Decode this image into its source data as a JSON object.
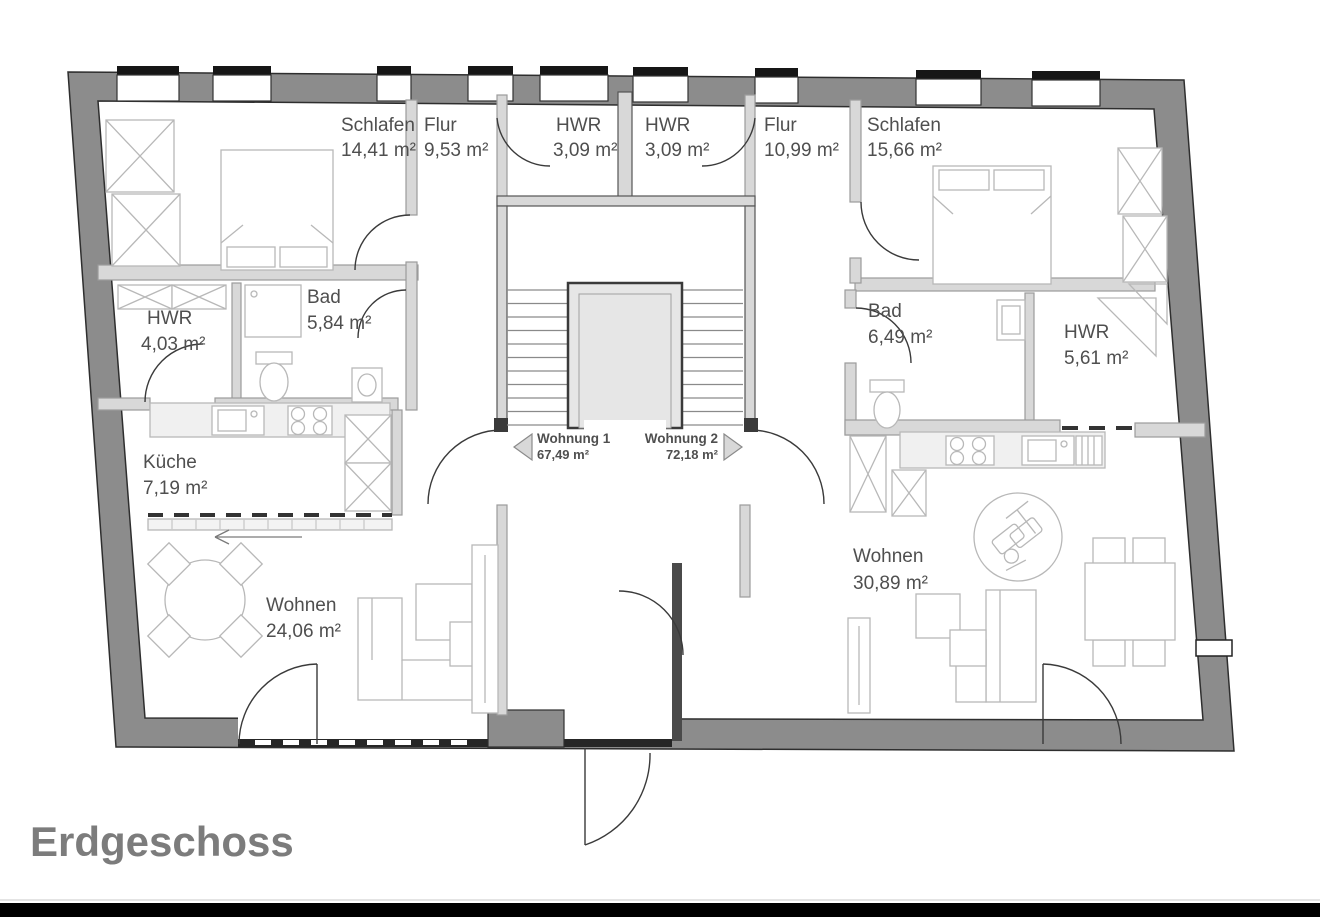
{
  "title": "Erdgeschoss",
  "floor_plan": {
    "apartments": [
      {
        "label": "Wohnung 1",
        "area": "67,49 m²"
      },
      {
        "label": "Wohnung 2",
        "area": "72,18 m²"
      }
    ],
    "rooms": [
      {
        "name": "Schlafen",
        "area": "14,41 m²"
      },
      {
        "name": "Flur",
        "area": "9,53 m²"
      },
      {
        "name": "HWR",
        "area": "3,09 m²"
      },
      {
        "name": "HWR",
        "area": "3,09 m²"
      },
      {
        "name": "Flur",
        "area": "10,99 m²"
      },
      {
        "name": "Schlafen",
        "area": "15,66 m²"
      },
      {
        "name": "HWR",
        "area": "4,03 m²"
      },
      {
        "name": "Bad",
        "area": "5,84 m²"
      },
      {
        "name": "Bad",
        "area": "6,49 m²"
      },
      {
        "name": "HWR",
        "area": "5,61 m²"
      },
      {
        "name": "Küche",
        "area": "7,19 m²"
      },
      {
        "name": "Wohnen",
        "area": "24,06 m²"
      },
      {
        "name": "Wohnen",
        "area": "30,89 m²"
      }
    ],
    "colors": {
      "wall": "#8c8c8c",
      "partition": "#d8d8d8",
      "dark_line": "#2e2e2e",
      "furniture": "#b8b8b8",
      "label_text": "#4f4f4f",
      "title_text": "#7c7c7c"
    }
  }
}
